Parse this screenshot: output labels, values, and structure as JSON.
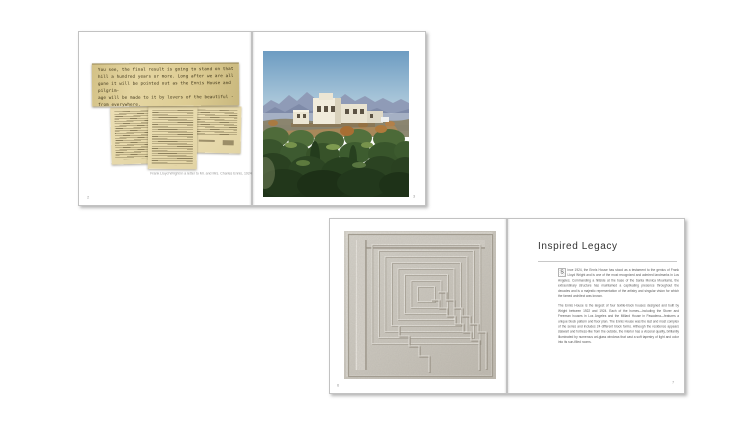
{
  "book": {
    "spread_top": {
      "left_page": {
        "page_number": "2",
        "note_lines": [
          "You see, the final result is going to stand on that",
          "hill a hundred years or more.  Long after we are all",
          "gone it will be pointed out as the Ennis House and pilgrim-",
          "age will be made to it by lovers of the beautiful -",
          "from everywhere."
        ],
        "caption": "Frank Lloyd Wright in a letter to Mr. and Mrs. Charles Ennis, 1924"
      },
      "right_page": {
        "page_number": "3"
      }
    },
    "spread_bottom": {
      "left_page": {
        "page_number": "6"
      },
      "right_page": {
        "page_number": "7",
        "title": "Inspired Legacy",
        "drop_cap": "S",
        "paragraphs": [
          "ince 1924, the Ennis House has stood as a testament to the genius of Frank Lloyd Wright and is one of the most recognized and admired landmarks in Los Angeles. Commanding a hillside at the base of the Santa Monica Mountains, the extraordinary structure has maintained a captivating presence throughout the decades and is a majestic representation of the artistry and singular vision for which the famed architect was known.",
          "The Ennis House is the largest of four textile-block houses designed and built by Wright between 1922 and 1924. Each of the homes—including the Storer and Freeman houses in Los Angeles and the Millard House in Pasadena—features a unique block pattern and floor plan. The Ennis House was the last and most complex of the series and includes 24 different block forms. Although the residence appears stalwart and fortress-like from the outside, the interior has a visceral quality, brilliantly illuminated by numerous art-glass windows that cast a soft tapestry of light and color into its sun-filled rooms."
        ]
      }
    }
  },
  "colors": {
    "page": "#ffffff",
    "note_paper": "#e0d09b",
    "document_paper": "#e9dcb0",
    "title_text": "#333333",
    "body_text": "#5a5a5a",
    "caption_text": "#989898",
    "rule": "#c8c8c8"
  }
}
